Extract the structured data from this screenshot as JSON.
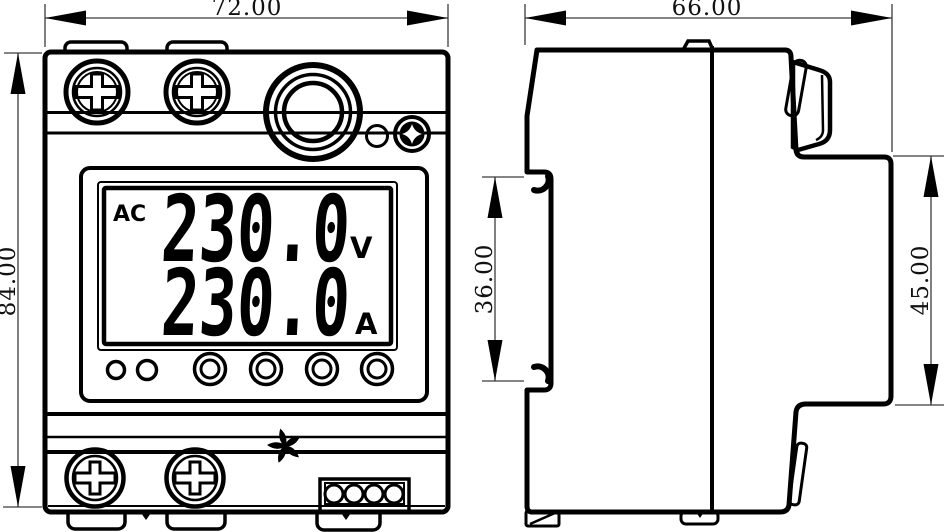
{
  "drawing": {
    "front_view": {
      "width_dim": "72.00",
      "height_dim": "84.00",
      "lcd": {
        "mode": "AC",
        "voltage": "230.0",
        "voltage_unit": "V",
        "current": "230.0",
        "current_unit": "A"
      }
    },
    "side_view": {
      "width_dim": "66.00",
      "rail_slot_dim": "36.00",
      "front_section_dim": "45.00"
    },
    "icons": {
      "top_screws": "phillips-screw",
      "bottom_screws": "phillips-screw",
      "knob": "round-test-button",
      "reset_screw": "cross-set-screw",
      "indicator": "led-dot",
      "reset_marker": "five-petal-asterisk",
      "terminals": "terminal-block-4"
    },
    "colors": {
      "line": "#000000",
      "dim_line": "#3c3c3c",
      "background": "#ffffff"
    }
  }
}
